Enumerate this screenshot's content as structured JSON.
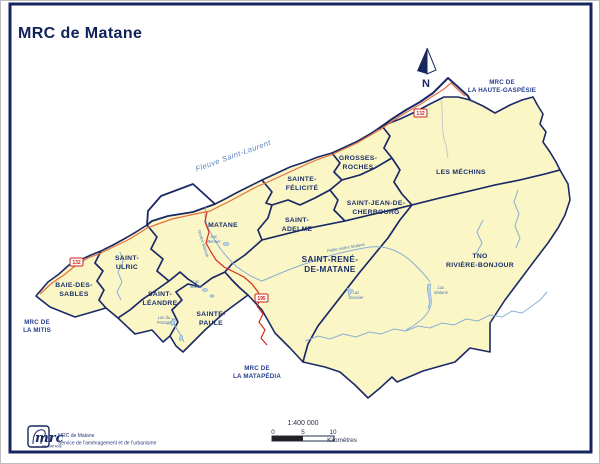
{
  "page": {
    "title": "MRC de Matane"
  },
  "map": {
    "municipalities": {
      "baie_des_sables": [
        "BAIE-DES-",
        "SABLES"
      ],
      "saint_ulric": [
        "SAINT-",
        "ULRIC"
      ],
      "saint_leandre": [
        "SAINT-",
        "LÉANDRE"
      ],
      "sainte_paule": [
        "SAINTE-",
        "PAULE"
      ],
      "matane": [
        "MATANE"
      ],
      "sainte_felicite": [
        "SAINTE-",
        "FÉLICITÉ"
      ],
      "grosses_roches": [
        "GROSSES-",
        "ROCHES"
      ],
      "saint_adelme": [
        "SAINT-",
        "ADELME"
      ],
      "saint_jean_de_cherbourg": [
        "SAINT-JEAN-DE-",
        "CHERBOURG"
      ],
      "les_mechins": [
        "LES MÉCHINS"
      ],
      "saint_rene_de_matane": [
        "SAINT-RENÉ-",
        "DE-MATANE"
      ],
      "tno_riviere_bonjour": [
        "TNO",
        "RIVIÈRE-BONJOUR"
      ]
    },
    "neighbors": {
      "haute_gaspesie": [
        "MRC DE",
        "LA HAUTE-GASPÉSIE"
      ],
      "la_mitis": [
        "MRC DE",
        "LA MITIS"
      ],
      "la_matapedia": [
        "MRC DE",
        "LA MATAPÉDIA"
      ]
    },
    "water": {
      "fleuve": "Fleuve Saint-Laurent",
      "lac_bernier": [
        "Lac",
        "Bernier"
      ],
      "lac_malfait": [
        "Lac",
        "Malfait"
      ],
      "lac_du_portage": [
        "Lac du",
        "Portage"
      ],
      "lac_matane": [
        "Lac",
        "Matane"
      ],
      "lac_duvivier": [
        "Lac",
        "Duvivier"
      ],
      "riviere_matane": "Rivière Matane",
      "petite_riviere_matane": "Petite rivière Matane"
    },
    "roads": {
      "route_132": "132",
      "route_195": "195"
    },
    "north": "N"
  },
  "scale": {
    "ratio": "1:400 000",
    "tick0": "0",
    "tick5": "5",
    "tick10": "10",
    "unit": "Kilomètres"
  },
  "credits": {
    "logo": "mrc",
    "logo_sub": "DE MATANE",
    "org": "MRC de Matane",
    "dept": "Service de l'aménagement et de l'urbanisme"
  },
  "colors": {
    "land": "#FAF6C6",
    "boundary": "#1B2A66",
    "water": "#8AAFD4",
    "route132": "#E4703C",
    "route195": "#D42B1E",
    "label": "#1B2F6B"
  }
}
